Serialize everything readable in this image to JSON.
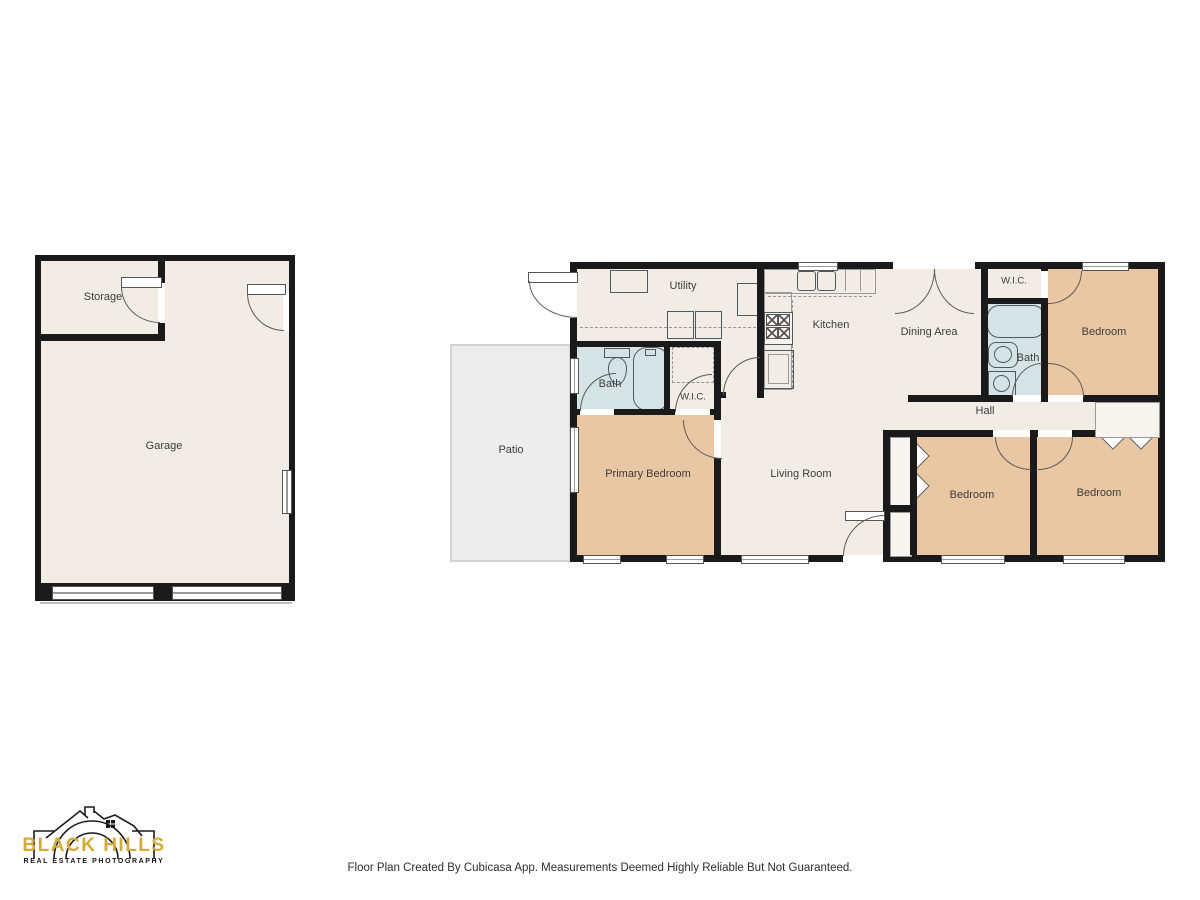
{
  "footer": {
    "text": "Floor Plan Created By Cubicasa App. Measurements Deemed Highly Reliable But Not Guaranteed."
  },
  "logo": {
    "title": "BLACK HILLS",
    "subtitle": "REAL ESTATE PHOTOGRAPHY"
  },
  "garage_building": {
    "storage": "Storage",
    "garage": "Garage"
  },
  "exterior": {
    "patio": "Patio"
  },
  "house": {
    "utility": "Utility",
    "kitchen": "Kitchen",
    "dining": "Dining Area",
    "wic_left": "W.I.C.",
    "bath_left": "Bath",
    "wic_right": "W.I.C.",
    "bath_right": "Bath",
    "hall": "Hall",
    "primary_bedroom": "Primary Bedroom",
    "living_room": "Living Room",
    "bedroom_top_right": "Bedroom",
    "bedroom_bottom_middle": "Bedroom",
    "bedroom_bottom_right": "Bedroom"
  },
  "colors": {
    "wall": "#1a1a1a",
    "floor": "#f2ece7",
    "bedroom": "#eac7a3",
    "bath": "#d5e3e4",
    "patio": "#ededed",
    "logo_gold": "#d4ab3a"
  }
}
